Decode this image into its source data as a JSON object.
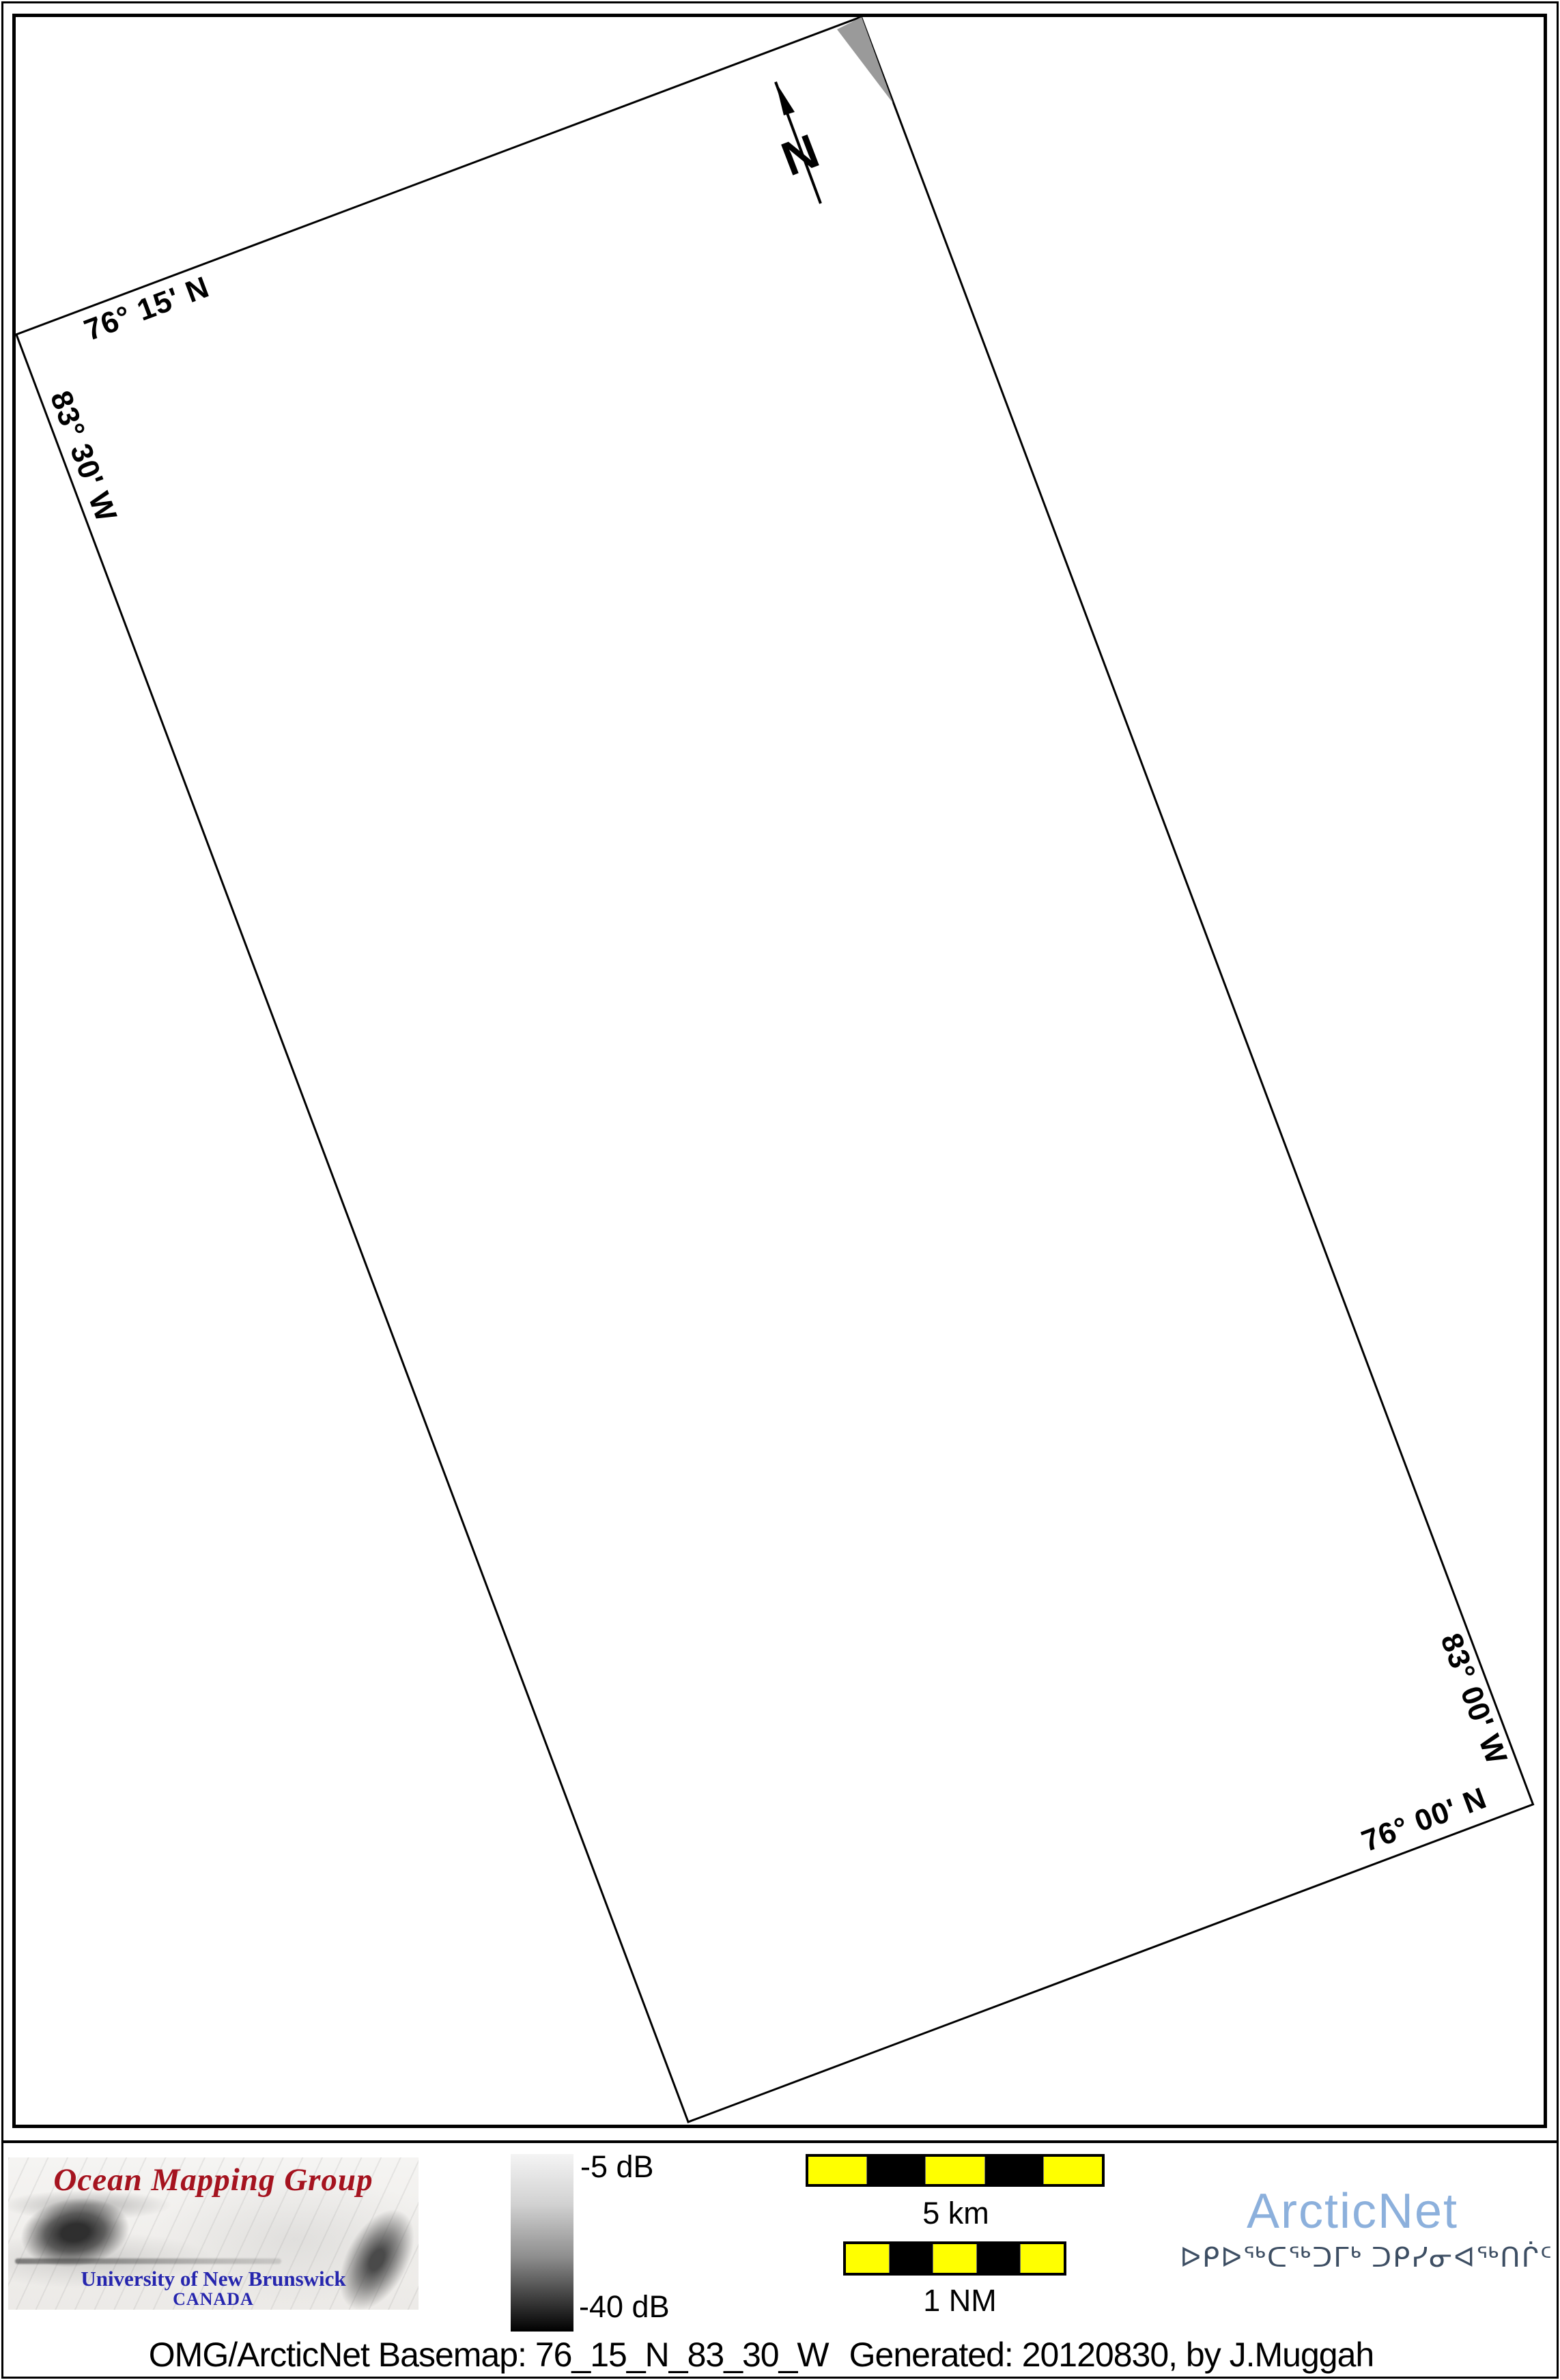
{
  "map": {
    "boundary_labels": {
      "lat_top": "76° 15' N",
      "lon_left": "83° 30' W",
      "lon_right": "83° 00' W",
      "lat_bottom": "76° 00' N"
    },
    "north_arrow_label": "N"
  },
  "legend": {
    "colorbar": {
      "top_label": "-5 dB",
      "bottom_label": "-40 dB",
      "top_color": "#f4f4f4",
      "bottom_color": "#000000"
    },
    "scalebars": [
      {
        "label": "5 km",
        "segment_colors": [
          "#ffff00",
          "#000000",
          "#ffff00",
          "#000000",
          "#ffff00"
        ]
      },
      {
        "label": "1 NM",
        "segment_colors": [
          "#ffff00",
          "#000000",
          "#ffff00",
          "#000000",
          "#ffff00"
        ]
      }
    ]
  },
  "logos": {
    "omg": {
      "title": "Ocean Mapping Group",
      "university": "University of New Brunswick",
      "country": "CANADA",
      "title_color": "#a5131f",
      "subtitle_color": "#2626ae"
    },
    "arcticnet": {
      "name": "ArcticNet",
      "tagline_syllabics": "ᐅᑭᐅᖅᑕᖅᑐᒥᒃ ᑐᑭᓯᓂᐊᖅᑎᒌᑦ",
      "name_color": "#8cb0dc",
      "tagline_color": "#3d4e63"
    }
  },
  "caption": {
    "basemap": "OMG/ArcticNet Basemap: 76_15_N_83_30_W",
    "generated": "Generated: 20120830, by J.Muggah"
  }
}
